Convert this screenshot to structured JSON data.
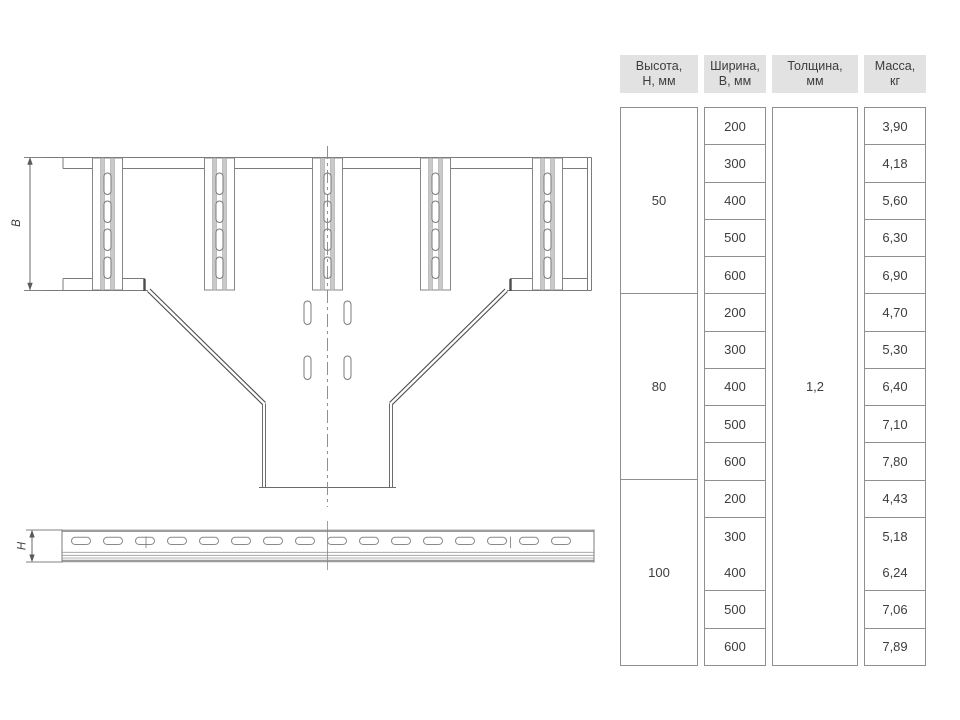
{
  "drawing": {
    "width_dim_label": "В",
    "height_dim_label": "Н"
  },
  "table": {
    "headers": [
      {
        "line1": "Высота,",
        "line2": "Н, мм"
      },
      {
        "line1": "Ширина,",
        "line2": "В, мм"
      },
      {
        "line1": "Толщина,",
        "line2": "мм"
      },
      {
        "line1": "Масса,",
        "line2": "кг"
      }
    ],
    "thickness": "1,2",
    "groups": [
      {
        "height": "50",
        "rows": [
          {
            "width": "200",
            "mass": "3,90"
          },
          {
            "width": "300",
            "mass": "4,18"
          },
          {
            "width": "400",
            "mass": "5,60"
          },
          {
            "width": "500",
            "mass": "6,30"
          },
          {
            "width": "600",
            "mass": "6,90"
          }
        ]
      },
      {
        "height": "80",
        "rows": [
          {
            "width": "200",
            "mass": "4,70"
          },
          {
            "width": "300",
            "mass": "5,30"
          },
          {
            "width": "400",
            "mass": "6,40"
          },
          {
            "width": "500",
            "mass": "7,10"
          },
          {
            "width": "600",
            "mass": "7,80"
          }
        ]
      },
      {
        "height": "100",
        "rows": [
          {
            "width": "200",
            "mass": "4,43"
          },
          {
            "width": "300",
            "mass": "5,18"
          },
          {
            "width": "400",
            "mass": "6,24"
          },
          {
            "width": "500",
            "mass": "7,06"
          },
          {
            "width": "600",
            "mass": "7,89"
          }
        ]
      }
    ]
  },
  "colors": {
    "header_bg": "#e2e2e2",
    "table_border": "#8f8f8f",
    "text": "#3d3d3d",
    "drawing_line": "#6f6f6f"
  }
}
